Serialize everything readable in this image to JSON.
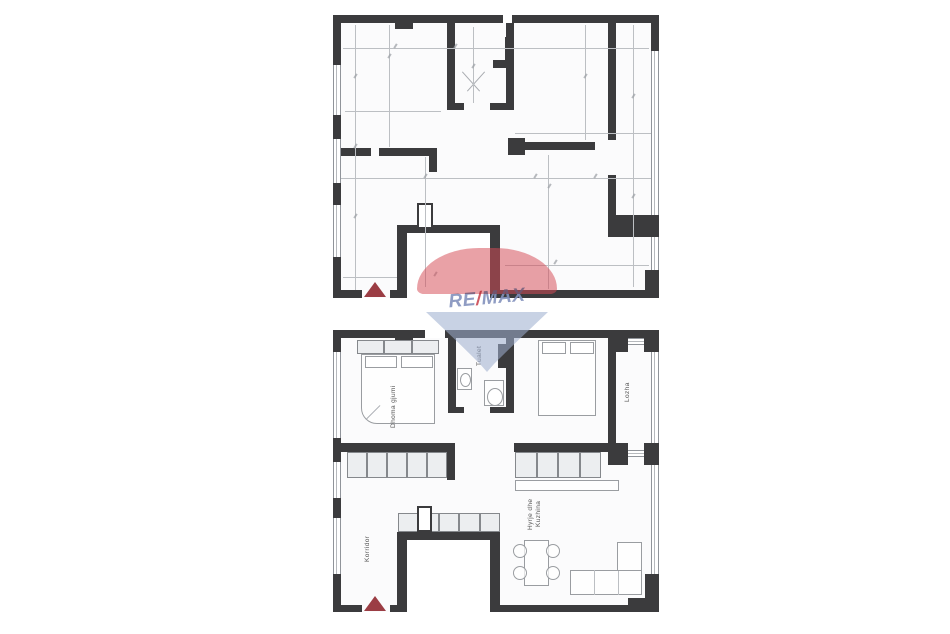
{
  "canvas": {
    "width": 950,
    "height": 634,
    "background": "#ffffff"
  },
  "watermark": {
    "re": "RE",
    "slash": "/",
    "max": "MAX",
    "dome_color": "#d54c56",
    "cone_color": "#9eaecf",
    "text_color": "#8392bd",
    "slash_color": "#cd4a55"
  },
  "colors": {
    "wall": "#3b3b3d",
    "thin_line": "#bcbfc3",
    "furniture_line": "#9a9da1",
    "cabinet_fill": "#eceef0",
    "entrance_marker": "#9b3d44",
    "plan_background": "#fbfbfc"
  },
  "bottom_plan": {
    "rooms": [
      {
        "id": "bedroom-left",
        "label": "Dhoma gjumi"
      },
      {
        "id": "toilet",
        "label": "Tualet"
      },
      {
        "id": "loggia",
        "label": "Lozha"
      },
      {
        "id": "corridor",
        "label": "Korridor"
      },
      {
        "id": "kitchen-entry",
        "label_line1": "Hyrje dhe",
        "label_line2": "Kuzhina"
      }
    ]
  }
}
